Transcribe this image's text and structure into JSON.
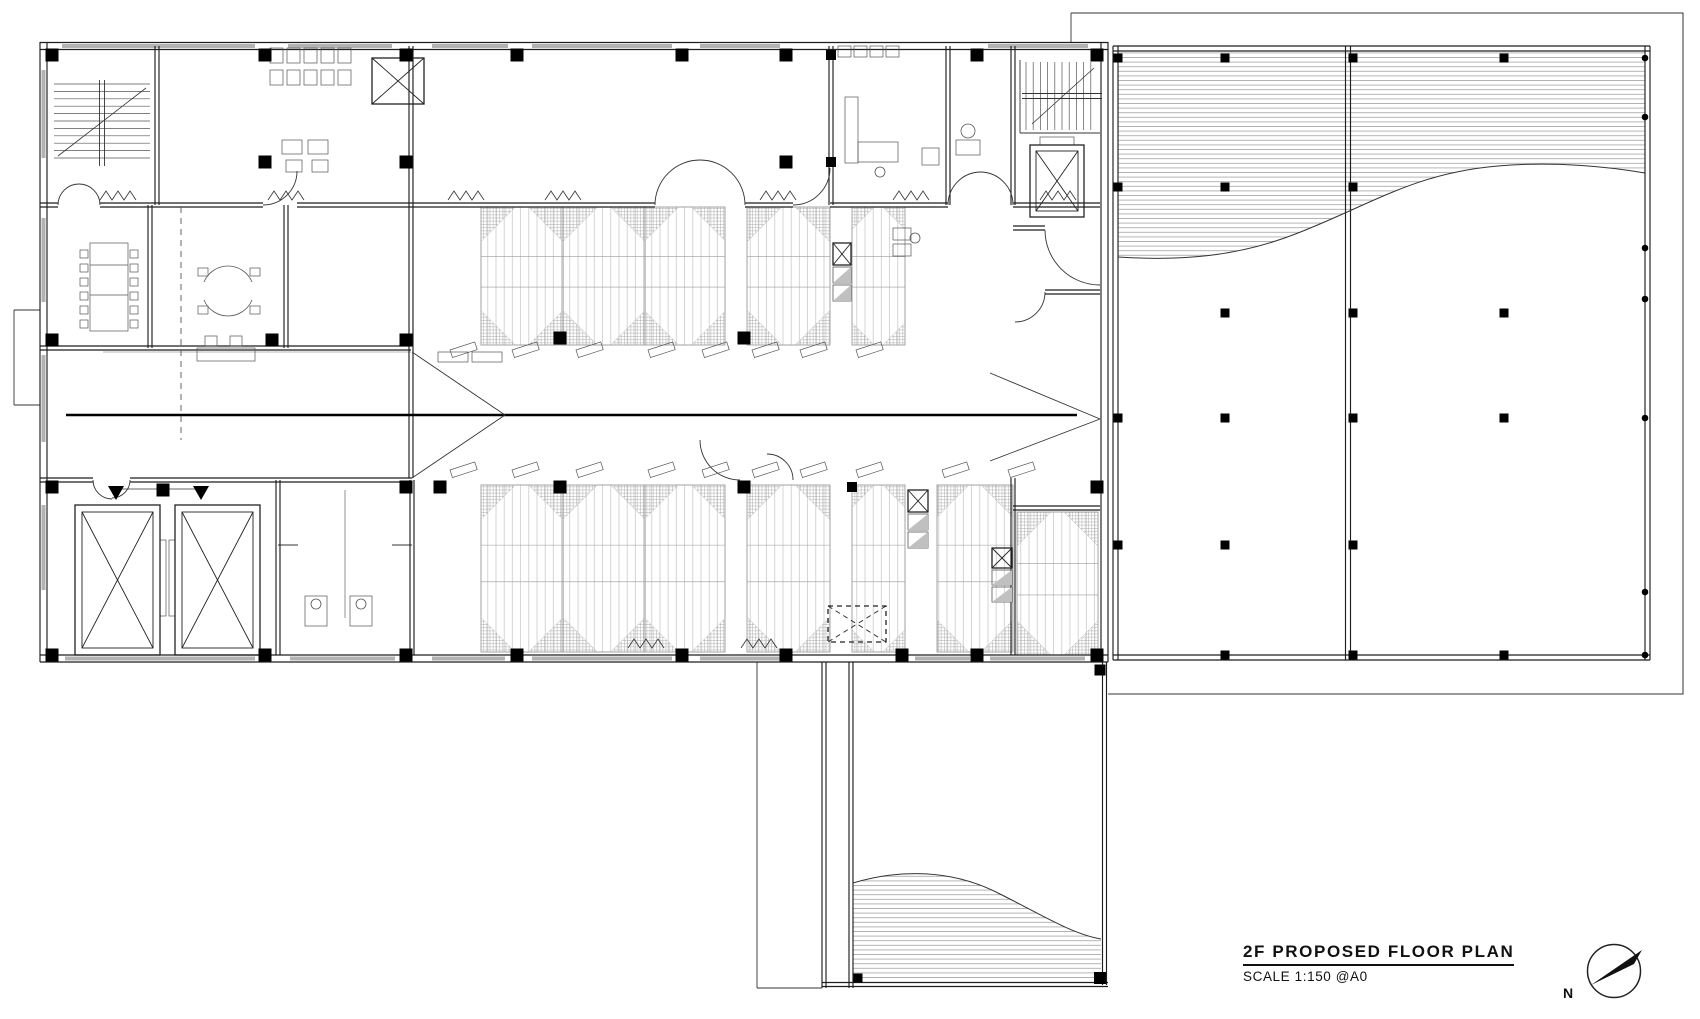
{
  "drawing": {
    "title": "2F  PROPOSED  FLOOR  PLAN",
    "scale_label": "SCALE 1:150 @A0",
    "north_label": "N"
  },
  "colors": {
    "ink": "#1e1e1e",
    "light": "#9a9a9a",
    "hatch": "#a5a5a5",
    "deck": "#787878",
    "window": "#b3b3b3"
  },
  "north": {
    "cx": 1614,
    "cy": 971,
    "r": 26.5,
    "needle": [
      [
        1591,
        985
      ],
      [
        1642,
        950
      ],
      [
        1634,
        964
      ]
    ]
  },
  "plan": {
    "hatch_regions": [
      "M1118,51 H1645 V173 C1610,167 1555,161 1498,166 C1415,173 1372,204 1298,233 C1238,257 1180,261 1118,257 Z",
      "M853,883 C900,869 952,869 1000,894 C1042,915 1072,934 1101,939 V981 H853 Z"
    ],
    "panels": [
      [
        481,
        207,
        82,
        138
      ],
      [
        563,
        207,
        82,
        138
      ],
      [
        645,
        207,
        80,
        138
      ],
      [
        747,
        207,
        83,
        138
      ],
      [
        852,
        207,
        53,
        138
      ],
      [
        481,
        485,
        82,
        167
      ],
      [
        563,
        485,
        82,
        167
      ],
      [
        645,
        485,
        80,
        167
      ],
      [
        747,
        485,
        83,
        167
      ],
      [
        852,
        485,
        53,
        167
      ],
      [
        937,
        485,
        76,
        167
      ],
      [
        1017,
        512,
        81,
        143
      ]
    ],
    "windows": [
      [
        62,
        44,
        193,
        4
      ],
      [
        288,
        44,
        104,
        4
      ],
      [
        432,
        44,
        76,
        4
      ],
      [
        532,
        44,
        140,
        4
      ],
      [
        700,
        44,
        80,
        4
      ],
      [
        988,
        44,
        100,
        4
      ],
      [
        41.5,
        70,
        4,
        88
      ],
      [
        41.5,
        218,
        4,
        84
      ],
      [
        41.5,
        355,
        4,
        87
      ],
      [
        41.5,
        505,
        4,
        85
      ],
      [
        65,
        656.5,
        190,
        4
      ],
      [
        290,
        656.5,
        105,
        4
      ],
      [
        432,
        656.5,
        73,
        4
      ],
      [
        532,
        656.5,
        140,
        4
      ],
      [
        700,
        656.5,
        80,
        4
      ],
      [
        915,
        656.5,
        55,
        4
      ],
      [
        990,
        656.5,
        95,
        4
      ]
    ],
    "dwalls": [
      [
        40,
        46,
        1108,
        46,
        7
      ],
      [
        43.5,
        42,
        43.5,
        662,
        7
      ],
      [
        40,
        658.5,
        1108,
        658.5,
        7
      ],
      [
        1104.5,
        42,
        1104.5,
        662,
        7
      ],
      [
        157,
        46,
        157,
        205
      ],
      [
        411,
        46,
        411,
        478
      ],
      [
        831,
        46,
        831,
        205
      ],
      [
        948,
        46,
        948,
        205
      ],
      [
        1013,
        46,
        1013,
        205
      ],
      [
        40,
        205,
        58,
        205
      ],
      [
        100,
        205,
        263,
        205
      ],
      [
        297,
        205,
        411,
        205
      ],
      [
        411,
        205,
        655,
        205
      ],
      [
        745,
        205,
        793,
        205
      ],
      [
        830,
        205,
        948,
        205
      ],
      [
        1013,
        205,
        1100,
        205
      ],
      [
        150,
        205,
        150,
        348
      ],
      [
        286,
        205,
        286,
        348
      ],
      [
        40,
        348,
        411,
        348
      ],
      [
        40,
        480,
        93,
        480
      ],
      [
        130,
        480,
        278,
        480
      ],
      [
        278,
        480,
        412,
        480
      ],
      [
        278,
        480,
        278,
        655
      ],
      [
        412,
        480,
        412,
        655
      ],
      [
        1013,
        228,
        1045,
        228
      ],
      [
        1045,
        292,
        1100,
        292
      ],
      [
        1013,
        478,
        1013,
        655
      ],
      [
        1013,
        508,
        1100,
        508
      ],
      [
        824,
        662,
        824,
        988
      ],
      [
        851,
        662,
        851,
        988
      ],
      [
        1104.5,
        662,
        1104.5,
        985
      ],
      [
        822,
        984.5,
        1108,
        984.5
      ],
      [
        1115.5,
        46,
        1115.5,
        660,
        5
      ],
      [
        1647.5,
        46,
        1647.5,
        660,
        5
      ],
      [
        1348,
        46,
        1348,
        660,
        5
      ],
      [
        1113,
        48.5,
        1650,
        48.5,
        5
      ],
      [
        1113,
        657.5,
        1650,
        657.5,
        5
      ]
    ],
    "lines": [
      [
        1071,
        13,
        1071,
        42
      ],
      [
        757,
        662,
        757,
        988
      ],
      [
        757,
        988,
        822,
        988
      ],
      [
        14,
        310,
        40,
        310
      ],
      [
        14,
        310,
        14,
        405
      ],
      [
        14,
        405,
        40,
        405
      ],
      [
        103,
        352,
        411,
        352,
        0.6,
        "#777"
      ],
      [
        345,
        490,
        345,
        618,
        0.8,
        "#777"
      ],
      [
        278,
        545,
        298,
        545
      ],
      [
        392,
        545,
        412,
        545
      ],
      [
        116,
        489,
        201,
        489,
        0.7
      ],
      [
        90,
        265,
        128,
        265,
        0.7,
        "#555"
      ],
      [
        90,
        295,
        128,
        295,
        0.7,
        "#555"
      ],
      [
        1020,
        60,
        1020,
        133
      ],
      [
        1020,
        133,
        1100,
        133
      ]
    ],
    "thick": [
      [
        66,
        415,
        1077,
        415
      ]
    ],
    "paths": [
      [
        "M1071,13 H1683 V694 H1108",
        1.0
      ],
      [
        "M1118,257 C1180,261 1238,257 1298,233 C1372,204 1415,173 1498,166 C1555,161 1610,167 1645,173",
        1.0
      ],
      [
        "M853,883 C900,869 952,869 1000,894 C1042,915 1072,934 1101,939",
        1.0
      ],
      [
        "M412,352 L505,415 L412,478",
        0.9
      ],
      [
        "M990,373 L1100,419",
        0.9
      ],
      [
        "M990,461 L1100,419",
        0.9
      ],
      [
        "M58,205 A21,21 0 0 1 79,184",
        0.9
      ],
      [
        "M100,205 A21,21 0 0 0 79,184",
        0.9
      ],
      [
        "M263,205 A34,34 0 0 0 297,171",
        0.9
      ],
      [
        "M655,205 A45,45 0 0 1 700,160",
        0.9
      ],
      [
        "M745,205 A45,45 0 0 0 700,160",
        0.9
      ],
      [
        "M793,205 A37,37 0 0 0 830,168",
        0.9
      ],
      [
        "M948,205 A33,33 0 0 1 981,172",
        0.9
      ],
      [
        "M1013,205 A33,33 0 0 0 980,172",
        0.9
      ],
      [
        "M93,480 A19,19 0 0 0 112,499",
        0.9
      ],
      [
        "M130,480 A18,18 0 0 1 112,498",
        0.9
      ],
      [
        "M1045,230 A55,55 0 0 0 1100,285",
        0.9
      ],
      [
        "M767,454 A26,26 0 0 1 793,480",
        0.9
      ],
      [
        "M700,440 A40,40 0 0 0 740,480",
        0.9
      ],
      [
        "M1045,292 A30,30 0 0 1 1015,322",
        0.9
      ]
    ],
    "dashed_paths": [
      [
        "M181,207 V440",
        0.9
      ]
    ],
    "rects": [
      [
        270,
        48,
        13,
        15
      ],
      [
        287,
        48,
        13,
        15
      ],
      [
        304,
        48,
        13,
        15
      ],
      [
        321,
        48,
        13,
        15
      ],
      [
        338,
        48,
        13,
        15
      ],
      [
        270,
        70,
        13,
        15
      ],
      [
        287,
        70,
        13,
        15
      ],
      [
        304,
        70,
        13,
        15
      ],
      [
        321,
        70,
        13,
        15
      ],
      [
        338,
        70,
        13,
        15
      ],
      [
        282,
        140,
        20,
        14
      ],
      [
        308,
        140,
        20,
        14
      ],
      [
        286,
        160,
        16,
        12
      ],
      [
        312,
        160,
        16,
        12
      ],
      [
        90,
        243,
        38,
        88
      ],
      [
        80,
        250,
        8,
        8
      ],
      [
        80,
        264,
        8,
        8
      ],
      [
        80,
        278,
        8,
        8
      ],
      [
        80,
        292,
        8,
        8
      ],
      [
        80,
        306,
        8,
        8
      ],
      [
        80,
        320,
        8,
        8
      ],
      [
        130,
        250,
        8,
        8
      ],
      [
        130,
        264,
        8,
        8
      ],
      [
        130,
        278,
        8,
        8
      ],
      [
        130,
        292,
        8,
        8
      ],
      [
        130,
        306,
        8,
        8
      ],
      [
        130,
        320,
        8,
        8
      ],
      [
        198,
        268,
        10,
        8
      ],
      [
        250,
        268,
        10,
        8
      ],
      [
        198,
        306,
        10,
        8
      ],
      [
        250,
        306,
        10,
        8
      ],
      [
        197,
        348,
        58,
        13
      ],
      [
        205,
        336,
        12,
        10
      ],
      [
        230,
        336,
        12,
        10
      ],
      [
        438,
        352,
        30,
        10
      ],
      [
        472,
        352,
        30,
        10
      ],
      [
        838,
        46,
        13,
        11
      ],
      [
        854,
        46,
        13,
        11
      ],
      [
        870,
        46,
        13,
        11
      ],
      [
        886,
        46,
        13,
        11
      ],
      [
        845,
        97,
        13,
        66
      ],
      [
        858,
        142,
        40,
        20
      ],
      [
        922,
        148,
        17,
        17
      ],
      [
        956,
        140,
        24,
        15
      ],
      [
        305,
        596,
        22,
        30
      ],
      [
        350,
        596,
        22,
        30
      ],
      [
        893,
        228,
        18,
        12
      ],
      [
        893,
        244,
        18,
        12
      ],
      [
        160,
        540,
        6,
        76
      ],
      [
        169,
        540,
        6,
        76
      ],
      [
        1040,
        137,
        34,
        8
      ]
    ],
    "sofa_arcs": [
      "M204,282 A26,26 0 0 1 252,282",
      "M252,300 A26,26 0 0 1 204,300"
    ],
    "xboxes": [
      [
        372,
        58,
        52,
        46,
        0,
        0
      ],
      [
        1030,
        145,
        54,
        72,
        6,
        0
      ],
      [
        75,
        505,
        85,
        150,
        7,
        0
      ],
      [
        175,
        505,
        85,
        150,
        7,
        0
      ],
      [
        828,
        606,
        58,
        36,
        0,
        1
      ],
      [
        833,
        243,
        18,
        22,
        0,
        0
      ],
      [
        908,
        490,
        20,
        22,
        0,
        0
      ],
      [
        992,
        548,
        20,
        20,
        0,
        0
      ]
    ],
    "shelves": [
      [
        833,
        267,
        18,
        16
      ],
      [
        833,
        285,
        18,
        16
      ],
      [
        908,
        514,
        20,
        16
      ],
      [
        908,
        532,
        20,
        16
      ],
      [
        992,
        570,
        20,
        15
      ],
      [
        992,
        587,
        20,
        15
      ]
    ],
    "stairs": [
      {
        "x": 54,
        "y": 84,
        "w": 96,
        "h": 78,
        "step": 7.4,
        "dir": "v",
        "diag": [
          58,
          156,
          146,
          88
        ]
      },
      {
        "x": 1026,
        "y": 62,
        "w": 72,
        "h": 68,
        "step": 7.2,
        "dir": "h",
        "diag": [
          1032,
          124,
          1094,
          68
        ]
      }
    ],
    "columns": [
      [
        52,
        55
      ],
      [
        265,
        55
      ],
      [
        406,
        55
      ],
      [
        517,
        55
      ],
      [
        682,
        55
      ],
      [
        786,
        55
      ],
      [
        831,
        55,
        10
      ],
      [
        977,
        55
      ],
      [
        1097,
        55
      ],
      [
        265,
        162
      ],
      [
        406,
        162
      ],
      [
        786,
        162
      ],
      [
        831,
        162,
        10
      ],
      [
        52,
        340
      ],
      [
        272,
        340
      ],
      [
        406,
        340
      ],
      [
        560,
        338
      ],
      [
        744,
        338
      ],
      [
        52,
        487
      ],
      [
        163,
        490
      ],
      [
        406,
        487
      ],
      [
        440,
        487
      ],
      [
        560,
        487
      ],
      [
        744,
        487
      ],
      [
        852,
        487,
        10
      ],
      [
        1097,
        487
      ],
      [
        52,
        655
      ],
      [
        265,
        655
      ],
      [
        406,
        655
      ],
      [
        517,
        655
      ],
      [
        682,
        655
      ],
      [
        786,
        655
      ],
      [
        902,
        655
      ],
      [
        977,
        655
      ],
      [
        1097,
        655
      ],
      [
        1100,
        670,
        11
      ],
      [
        1100,
        978,
        12
      ],
      [
        858,
        978,
        9
      ]
    ],
    "scols": [
      [
        1118,
        58
      ],
      [
        1225,
        58
      ],
      [
        1353,
        58
      ],
      [
        1504,
        58
      ],
      [
        1118,
        187
      ],
      [
        1225,
        187
      ],
      [
        1353,
        187
      ],
      [
        1225,
        313
      ],
      [
        1353,
        313
      ],
      [
        1504,
        313
      ],
      [
        1118,
        418
      ],
      [
        1225,
        418
      ],
      [
        1353,
        418
      ],
      [
        1504,
        418
      ],
      [
        1118,
        545
      ],
      [
        1225,
        545
      ],
      [
        1353,
        545
      ],
      [
        1225,
        655
      ],
      [
        1353,
        655
      ],
      [
        1504,
        655
      ]
    ],
    "dots": [
      [
        1645,
        58
      ],
      [
        1645,
        117
      ],
      [
        1645,
        248
      ],
      [
        1645,
        299
      ],
      [
        1645,
        418
      ],
      [
        1645,
        592
      ],
      [
        1645,
        655
      ]
    ],
    "tris": [
      [
        [
          108,
          486
        ],
        [
          124,
          486
        ],
        [
          116,
          500
        ]
      ],
      [
        [
          193,
          486
        ],
        [
          209,
          486
        ],
        [
          201,
          500
        ]
      ]
    ],
    "zigzags": [
      [
        100,
        200
      ],
      [
        268,
        200
      ],
      [
        448,
        200
      ],
      [
        545,
        200
      ],
      [
        760,
        200
      ],
      [
        893,
        200
      ],
      [
        1040,
        200
      ],
      [
        628,
        648
      ],
      [
        741,
        648
      ]
    ],
    "tilts": [
      [
        450,
        350
      ],
      [
        512,
        350
      ],
      [
        576,
        350
      ],
      [
        648,
        350
      ],
      [
        702,
        350
      ],
      [
        752,
        350
      ],
      [
        800,
        350
      ],
      [
        856,
        350
      ],
      [
        450,
        470
      ],
      [
        512,
        470
      ],
      [
        576,
        470
      ],
      [
        648,
        470
      ],
      [
        702,
        470
      ],
      [
        752,
        470
      ],
      [
        800,
        470
      ],
      [
        856,
        470
      ],
      [
        942,
        470
      ],
      [
        1008,
        470
      ]
    ],
    "circles": [
      [
        316,
        604,
        5
      ],
      [
        361,
        604,
        5
      ],
      [
        968,
        131,
        7
      ],
      [
        880,
        172,
        5
      ],
      [
        915,
        238,
        5
      ]
    ]
  }
}
